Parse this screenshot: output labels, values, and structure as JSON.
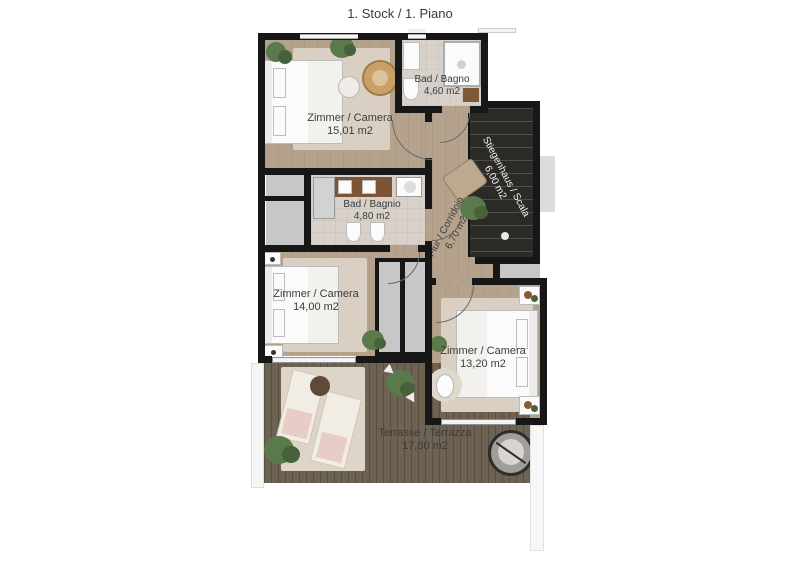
{
  "title": "1. Stock / 1. Piano",
  "rooms": {
    "bedroom1": {
      "name": "Zimmer / Camera",
      "area": "15,01 m2"
    },
    "bath1": {
      "name": "Bad / Bagno",
      "area": "4,60 m2"
    },
    "staircase": {
      "name": "Stiegenhaus / Scala",
      "area": "6,00 m2"
    },
    "bath2": {
      "name": "Bad / Bagnio",
      "area": "4,80 m2"
    },
    "corridor": {
      "name": "Flur / Corridoio",
      "area": "6,70 m2"
    },
    "bedroom2": {
      "name": "Zimmer / Camera",
      "area": "14,00 m2"
    },
    "bedroom3": {
      "name": "Zimmer / Camera",
      "area": "13,20 m2"
    },
    "terrace": {
      "name": "Terrasse / Terrazza",
      "area": "17,80 m2"
    }
  },
  "colors": {
    "wall": "#171717",
    "wood": "#b4a28c",
    "tile": "#d7d1ca",
    "deck": "#6e6253",
    "stairs": "#2b2a27",
    "rug": "#d9d0c3",
    "green": "#5a7a4c",
    "green2": "#47613a",
    "closet": "#c7c7c7",
    "txt": "#3c3c3c"
  }
}
